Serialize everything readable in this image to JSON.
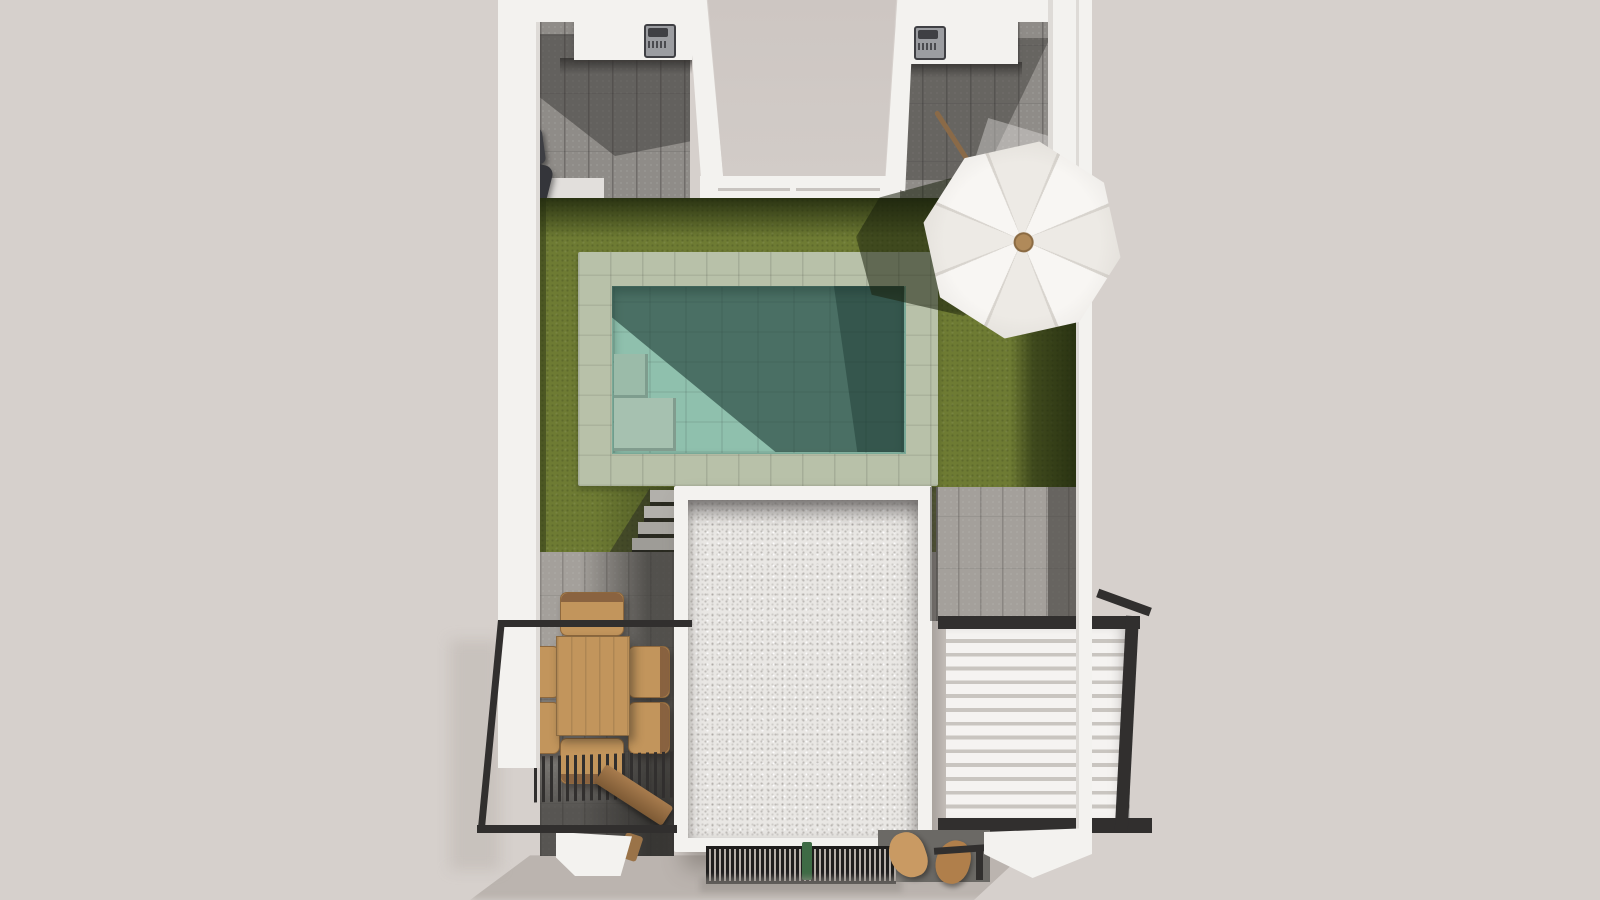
{
  "scene": {
    "description": "Aerial top-down 3D architectural rendering of a villa plot with swimming pool, lawn, terraces, pergolas and outdoor furniture",
    "view": "top-down 3D render",
    "objects": [
      {
        "name": "boundary-walls",
        "label": "White boundary walls"
      },
      {
        "name": "outdoor-kitchen-left",
        "label": "Left outdoor kitchen counter with grill"
      },
      {
        "name": "outdoor-kitchen-right",
        "label": "Right outdoor kitchen counter with grill"
      },
      {
        "name": "wall-barbecue",
        "label": "Wall-mounted barbecue unit"
      },
      {
        "name": "upper-terrace",
        "label": "Upper terrace between side wings"
      },
      {
        "name": "lawn",
        "label": "Garden lawn"
      },
      {
        "name": "swimming-pool",
        "label": "Tiled swimming pool"
      },
      {
        "name": "pool-steps",
        "label": "Pool corner steps"
      },
      {
        "name": "garden-stairs",
        "label": "Garden stairs"
      },
      {
        "name": "parasol",
        "label": "White garden parasol"
      },
      {
        "name": "dining-set",
        "label": "Wooden dining table with six chairs"
      },
      {
        "name": "balcony-railing",
        "label": "Black metal balcony railing"
      },
      {
        "name": "slatted-pergola",
        "label": "Dark slatted pergola"
      },
      {
        "name": "wooden-bench",
        "label": "Wooden bench"
      },
      {
        "name": "gravel-roof",
        "label": "White gravel flat roof"
      },
      {
        "name": "louvered-roof",
        "label": "White louvered pergola roof"
      },
      {
        "name": "ventilation-grate",
        "label": "Dark slatted grate"
      },
      {
        "name": "lounge-chairs",
        "label": "Wooden lounge chairs"
      },
      {
        "name": "stone-paving",
        "label": "Grey plank paving"
      }
    ]
  },
  "palette": {
    "background": "#d6d0cc",
    "wall": "#f3f2ef",
    "wall_shade": "#e2dfdc",
    "terrace_floor": "#cdc6c2",
    "plank_base": "#8f8c88",
    "plank_light": "#a4a09b",
    "lawn": "#6e7b33",
    "lawn_shadow": "#27330f",
    "pool_rim": "#b8c1a9",
    "pool_water": "#8fc0ad",
    "pool_water_shadow": "#2e574e",
    "gravel": "#e9e7e4",
    "frame_dark": "#312f2e",
    "wood": "#c2955c",
    "wood_dark": "#8a6340",
    "umbrella_a": "#f8f6f3",
    "umbrella_b": "#edeae5",
    "pole": "#8a6a48",
    "step_stone": "#b2b0ab",
    "grate_dark": "#1f1e1d",
    "plant_green": "#3e6b45",
    "shadow_soft": "#a89f98"
  }
}
